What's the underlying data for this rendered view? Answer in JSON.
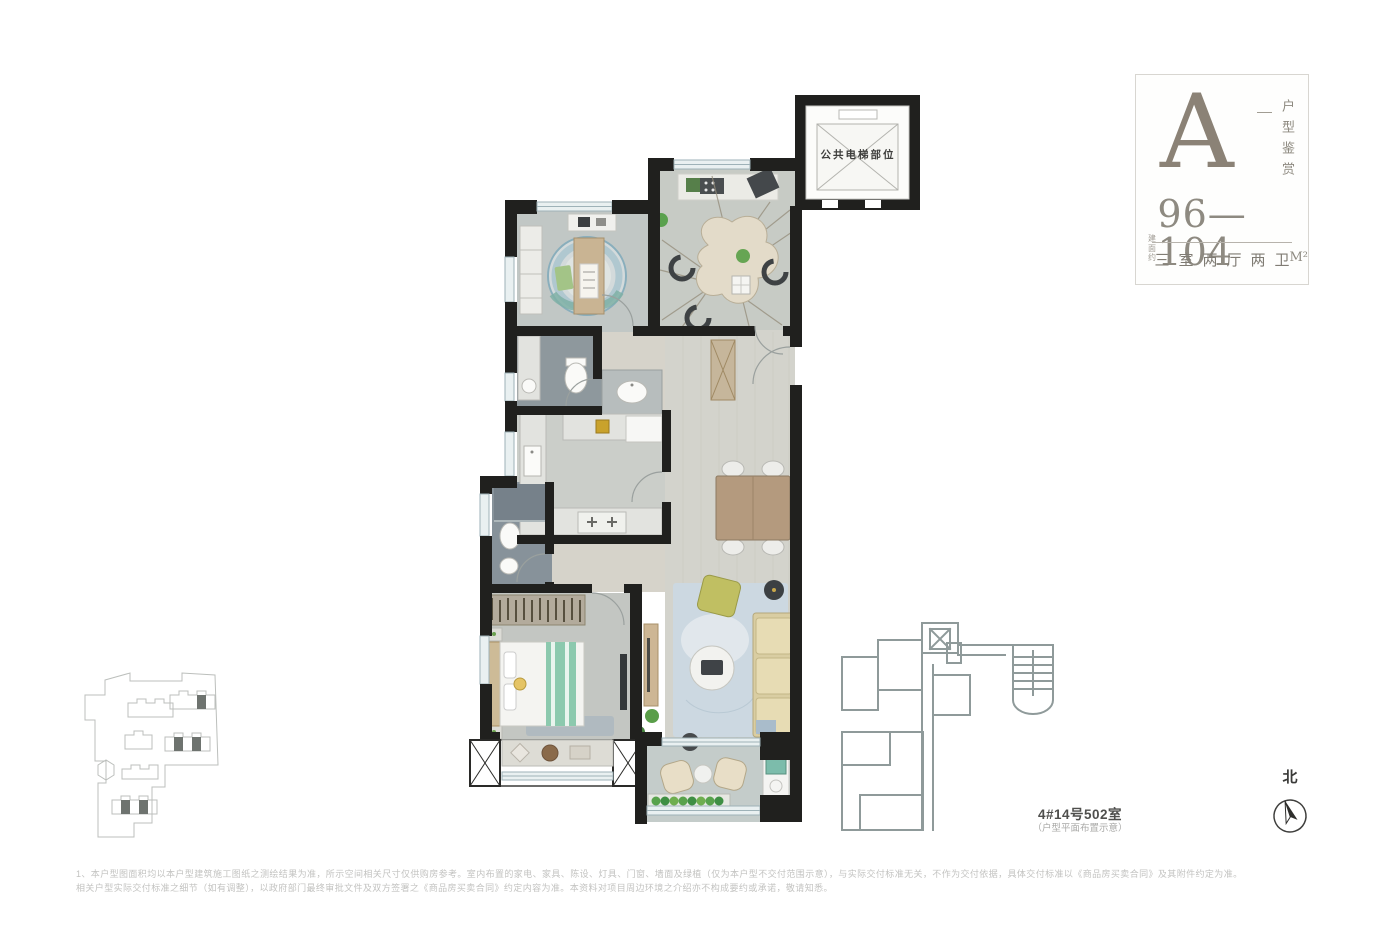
{
  "info_card": {
    "unit_letter": "A",
    "side_label": "户型鉴赏",
    "area_prefix": "建面约",
    "area_value": "96—104",
    "area_unit": "M²",
    "layout_label": "三室两厅两卫"
  },
  "floorplan": {
    "elevator_label": "公共电梯部位"
  },
  "keyplan": {
    "room_label": "4#14号502室",
    "room_sublabel": "（户型平面布置示意）"
  },
  "compass": {
    "north_label": "北"
  },
  "disclaimer": {
    "line1": "1、本户型图面积均以本户型建筑施工图纸之测绘结果为准，所示空间相关尺寸仅供购房参考。室内布置的家电、家具、陈设、灯具、门窗、墙面及绿植（仅为本户型不交付范围示意），与实际交付标准无关，不作为交付依据，具体交付标准以《商品房买卖合同》及其附件约定为准。",
    "line2": "相关户型实际交付标准之细节（如有调整），以政府部门最终审批文件及双方签署之《商品房买卖合同》约定内容为准。本资料对项目周边环境之介绍亦不构成要约或承诺，敬请知悉。"
  },
  "colors": {
    "wall": "#20201e",
    "floor_wood": "#d3d3cc",
    "bath_tile": "#8e989d",
    "bed_teal": "#8cc9ae",
    "rug_blue": "#ccd8e1",
    "sofa_cream": "#d9cda2",
    "title_taupe": "#8b8276",
    "keyplan_line": "#8f9a9a",
    "plant_green": "#58a24c"
  }
}
